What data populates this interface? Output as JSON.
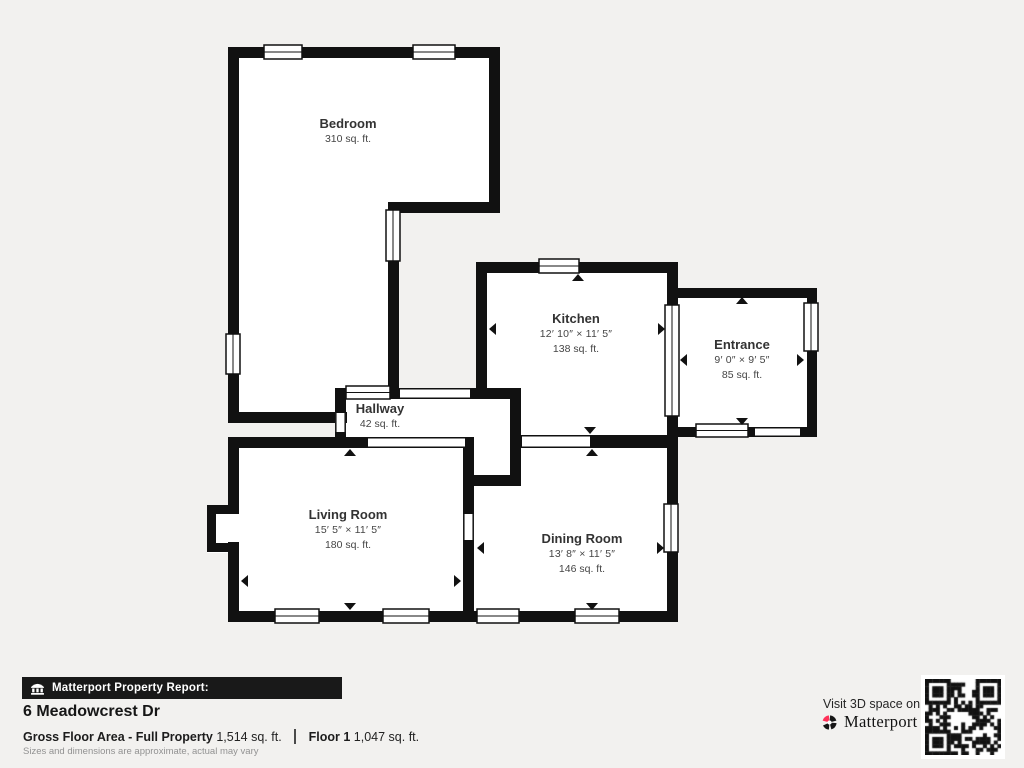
{
  "background": "#f2f1ef",
  "plan": {
    "wall_color": "#111111",
    "room_fill": "#ffffff",
    "rooms": [
      {
        "id": "bedroom",
        "name": "Bedroom",
        "dimensions": "",
        "area": "310 sq. ft."
      },
      {
        "id": "kitchen",
        "name": "Kitchen",
        "dimensions": "12′ 10″ × 11′ 5″",
        "area": "138 sq. ft."
      },
      {
        "id": "entrance",
        "name": "Entrance",
        "dimensions": "9′ 0″ × 9′ 5″",
        "area": "85 sq. ft."
      },
      {
        "id": "hallway",
        "name": "Hallway",
        "dimensions": "",
        "area": "42 sq. ft."
      },
      {
        "id": "living_room",
        "name": "Living Room",
        "dimensions": "15′ 5″ × 11′ 5″",
        "area": "180 sq. ft."
      },
      {
        "id": "dining_room",
        "name": "Dining Room",
        "dimensions": "13′ 8″ × 11′ 5″",
        "area": "146 sq. ft."
      }
    ]
  },
  "report": {
    "banner_label": "Matterport Property Report:",
    "address": "6 Meadowcrest Dr",
    "gross_floor_area_label": "Gross Floor Area - Full Property",
    "gross_floor_area_value": "1,514 sq. ft.",
    "floor_label": "Floor 1",
    "floor_value": "1,047 sq. ft.",
    "disclaimer": "Sizes and dimensions are approximate, actual may vary"
  },
  "promo": {
    "visit_text": "Visit 3D space on",
    "brand": "Matterport",
    "tm_mark": "™",
    "brand_accent": "#ff3158"
  }
}
